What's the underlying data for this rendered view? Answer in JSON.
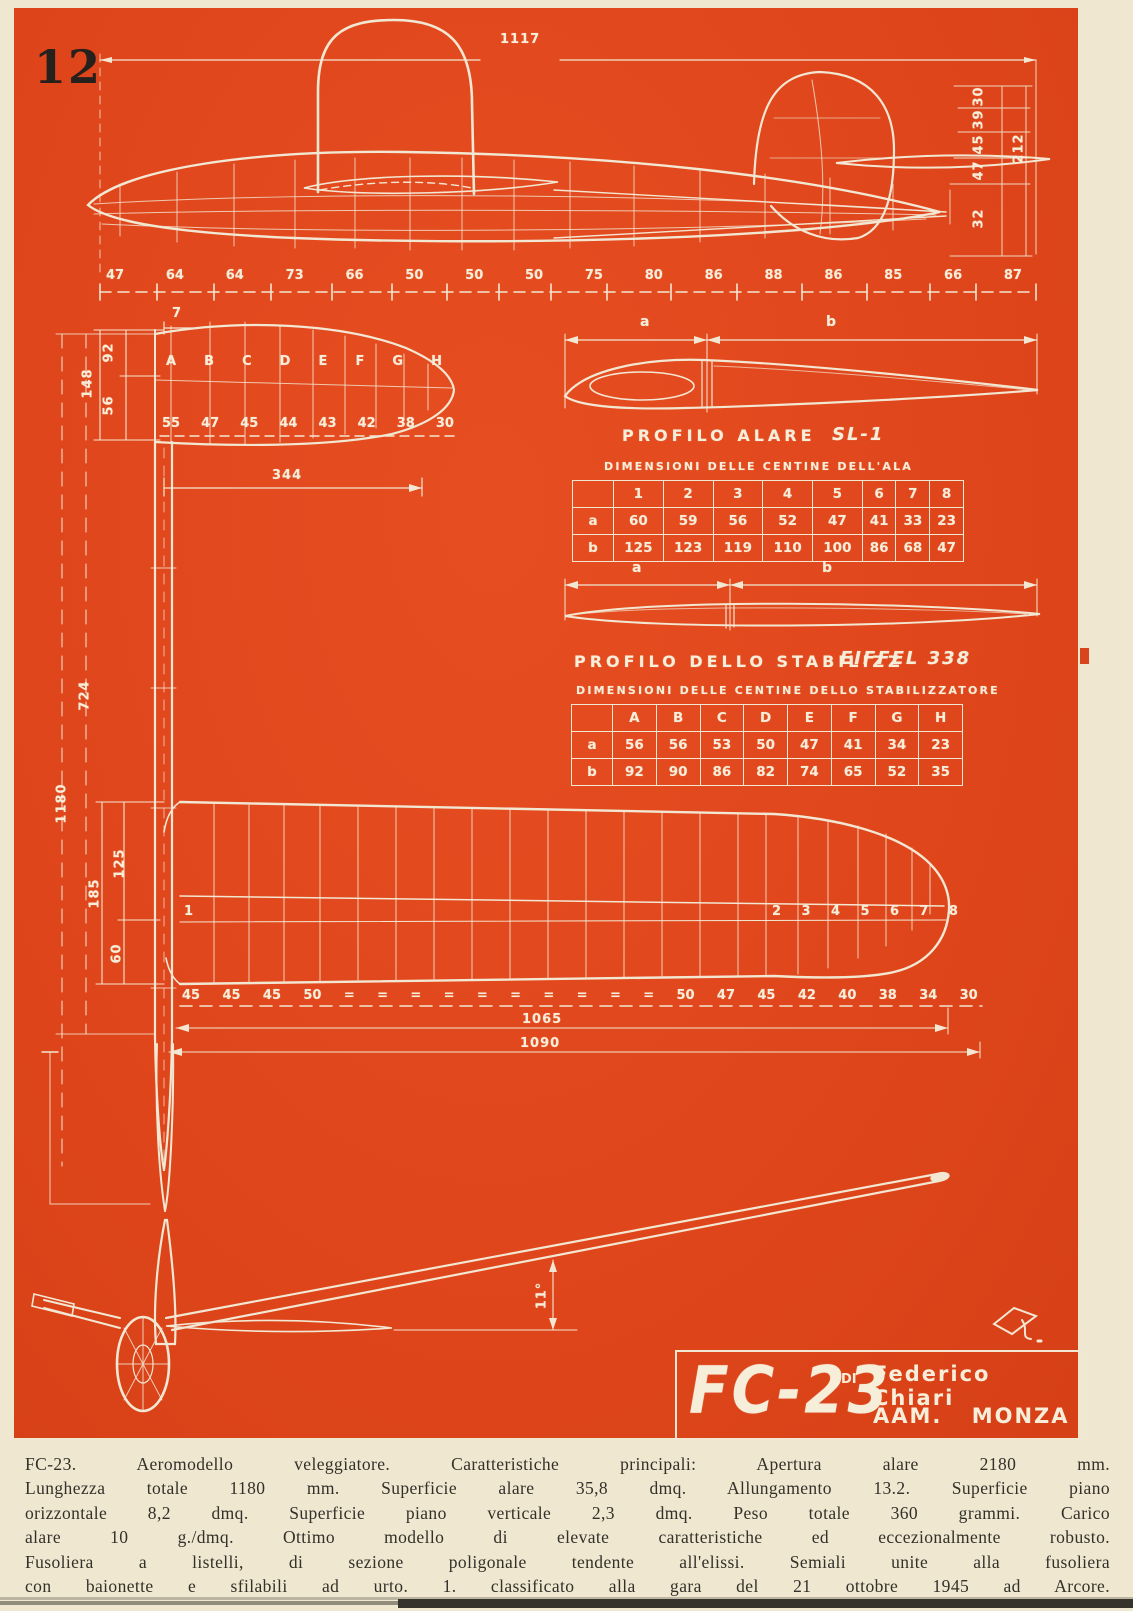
{
  "page": {
    "number": "12",
    "plate_color": "#e0461c",
    "paper_color": "#efe7d0",
    "line_color": "#f2e7d2"
  },
  "side_view": {
    "top_dim": "1117",
    "bottom_dims": [
      "47",
      "64",
      "64",
      "73",
      "66",
      "50",
      "50",
      "50",
      "75",
      "80",
      "86",
      "88",
      "86",
      "85",
      "66",
      "87"
    ],
    "right_dims": [
      "30",
      "39",
      "45",
      "47",
      "32"
    ],
    "right_total_dim": "212"
  },
  "stab_plan": {
    "tip_offset_dim": "7",
    "dim_92": "92",
    "dim_56": "56",
    "dim_148": "148",
    "rib_letters": [
      "A",
      "B",
      "C",
      "D",
      "E",
      "F",
      "G",
      "H"
    ],
    "spacing_dims": [
      "55",
      "47",
      "45",
      "44",
      "43",
      "42",
      "38",
      "30"
    ],
    "span_dim": "344"
  },
  "fuselage_plan": {
    "mid_dim": "724",
    "total_dim": "1180"
  },
  "wing_plan": {
    "dim_185": "185",
    "dim_125": "125",
    "dim_60": "60",
    "rib_number_root": "1",
    "rib_numbers_outer": [
      "2",
      "3",
      "4",
      "5",
      "6",
      "7",
      "8"
    ],
    "spacing_dims": [
      "45",
      "45",
      "45",
      "50",
      "=",
      "=",
      "=",
      "=",
      "=",
      "=",
      "=",
      "=",
      "=",
      "=",
      "50",
      "47",
      "45",
      "42",
      "40",
      "38",
      "34",
      "30"
    ],
    "span_dim_1": "1065",
    "span_dim_2": "1090"
  },
  "wing_profile": {
    "dim_a_label": "a",
    "dim_b_label": "b",
    "title": "PROFILO  ALARE",
    "airfoil_name": "SL-1",
    "table_caption": "DIMENSIONI  DELLE  CENTINE  DELL'ALA",
    "table": {
      "corner": "",
      "columns": [
        "1",
        "2",
        "3",
        "4",
        "5",
        "6",
        "7",
        "8"
      ],
      "rows": [
        {
          "label": "a",
          "values": [
            "60",
            "59",
            "56",
            "52",
            "47",
            "41",
            "33",
            "23"
          ]
        },
        {
          "label": "b",
          "values": [
            "125",
            "123",
            "119",
            "110",
            "100",
            "86",
            "68",
            "47"
          ]
        }
      ]
    }
  },
  "stab_profile": {
    "dim_a_label": "a",
    "dim_b_label": "b",
    "title": "PROFILO  DELLO  STABILIZZ",
    "airfoil_name": "EIFFEL 338",
    "table_caption": "DIMENSIONI  DELLE  CENTINE  DELLO  STABILIZZATORE",
    "table": {
      "corner": "",
      "columns": [
        "A",
        "B",
        "C",
        "D",
        "E",
        "F",
        "G",
        "H"
      ],
      "rows": [
        {
          "label": "a",
          "values": [
            "56",
            "56",
            "53",
            "50",
            "47",
            "41",
            "34",
            "23"
          ]
        },
        {
          "label": "b",
          "values": [
            "92",
            "90",
            "86",
            "82",
            "74",
            "65",
            "52",
            "35"
          ]
        }
      ]
    }
  },
  "front_view": {
    "dihedral_angle": "11°"
  },
  "title_block": {
    "model_name": "FC-23",
    "di_label": "DI",
    "designer": "Federico  Chiari",
    "club": "AAM. MONZA"
  },
  "caption": {
    "lines": [
      "FC-23.  Aeromodello  veleggiatore.  Caratteristiche  principali:  Apertura  alare  2180  mm.",
      "Lunghezza totale 1180 mm. Superficie alare 35,8 dmq. Allungamento 13.2. Superficie piano",
      "orizzontale 8,2 dmq. Superficie piano verticale 2,3 dmq. Peso totale 360 grammi. Carico",
      "alare 10 g./dmq. Ottimo modello di elevate caratteristiche ed eccezionalmente robusto.",
      "Fusoliera a listelli, di sezione poligonale tendente all'elissi. Semiali unite alla fusoliera",
      "con baionette e sfilabili ad urto. 1. classificato alla gara del 21 ottobre 1945 ad Arcore."
    ]
  }
}
